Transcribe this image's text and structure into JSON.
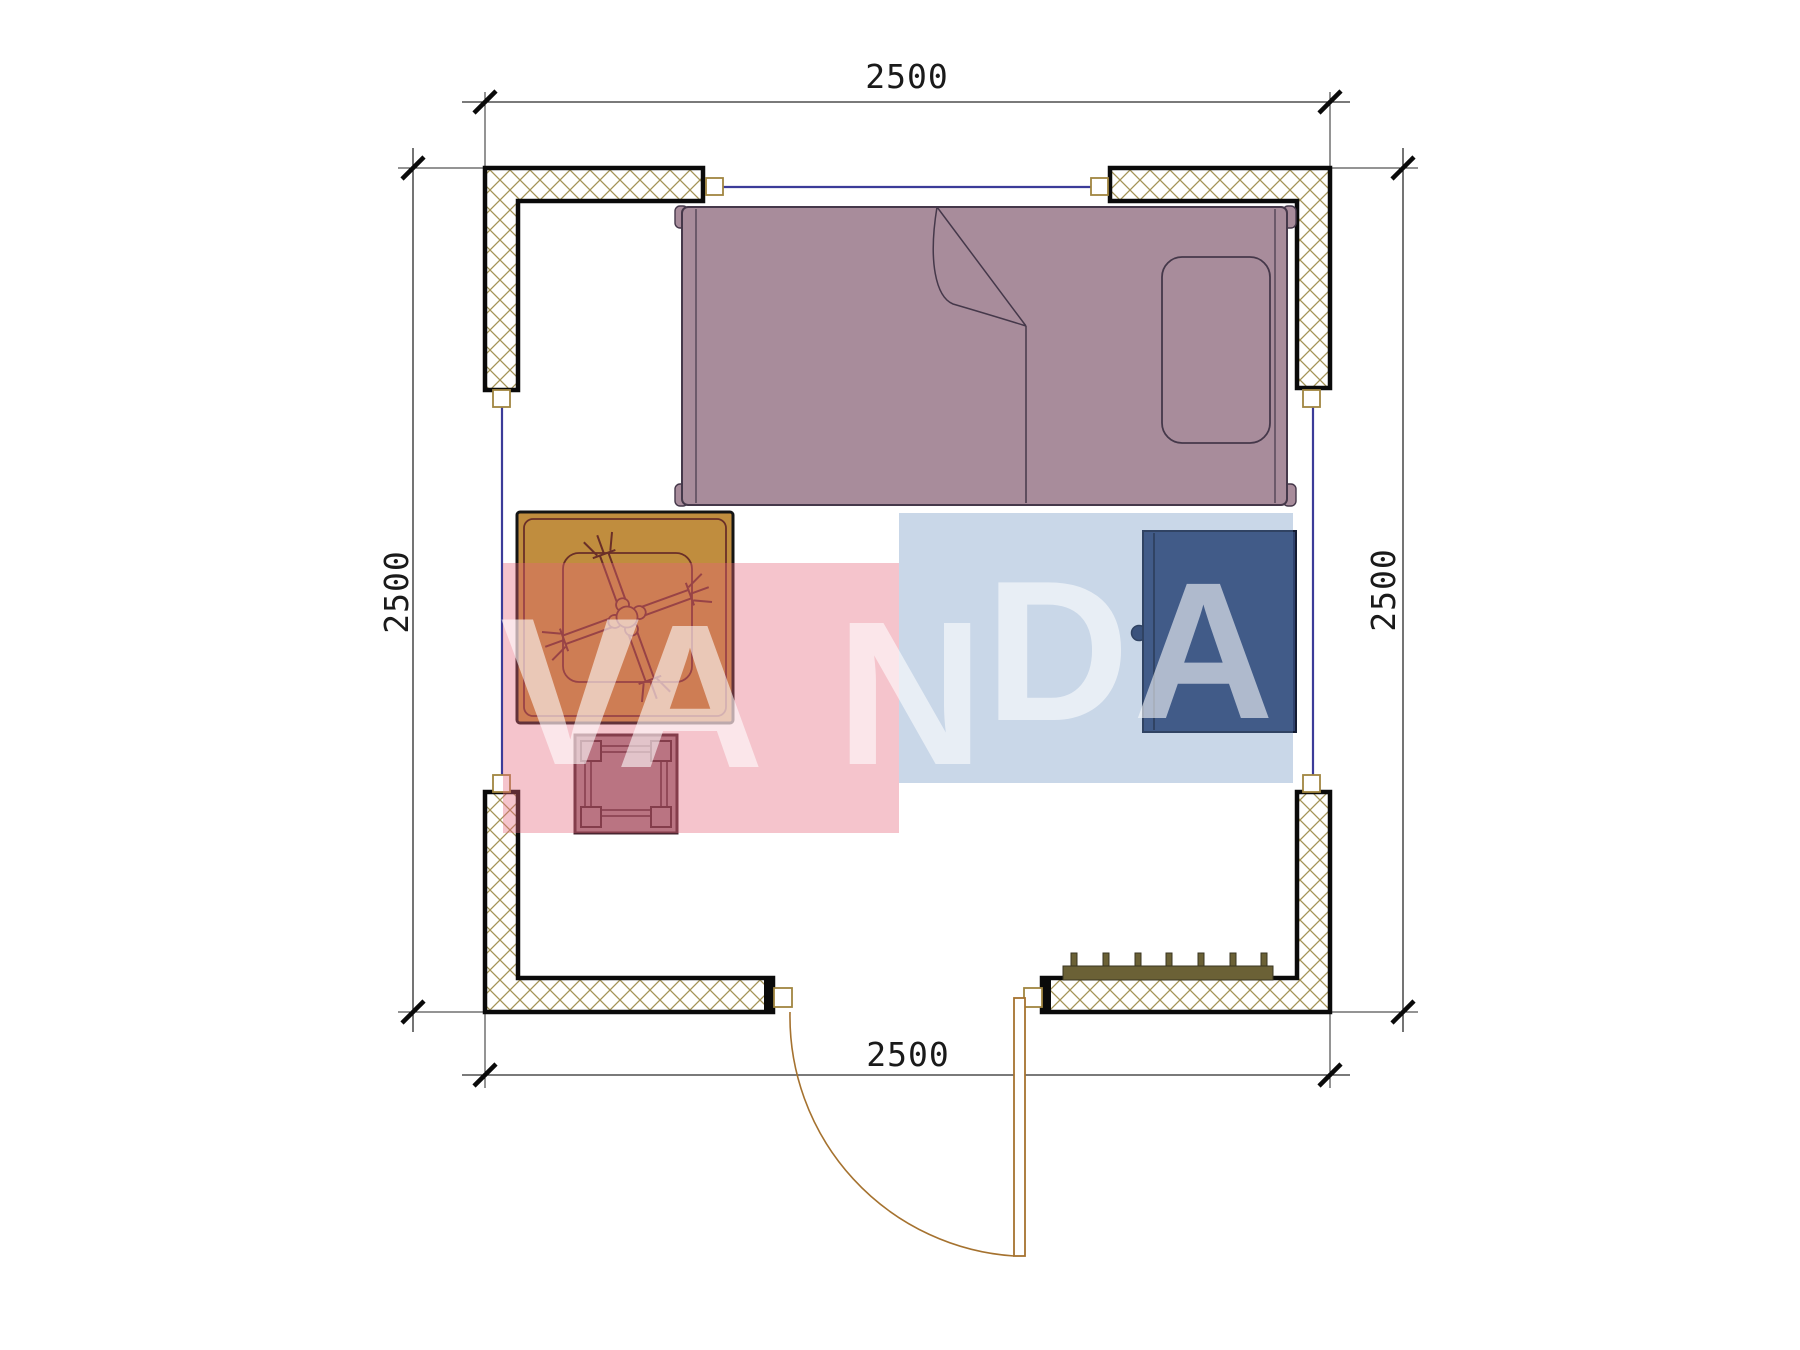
{
  "dimensions": {
    "top_label": "2500",
    "bottom_label": "2500",
    "left_label": "2500",
    "right_label": "2500",
    "color": "#1a1a1a"
  },
  "watermark": {
    "letters": [
      "V",
      "A",
      "N",
      "D",
      "A"
    ],
    "pink_color": "rgba(230,100,120,0.38)",
    "blue_color": "rgba(100,140,190,0.35)",
    "letter_color": "rgba(255,255,255,0.58)"
  },
  "plan": {
    "wall_hatch_color": "#a39356",
    "wall_border_color": "#0a0a0a",
    "window_line_color": "#3c3c99",
    "frame_color": "#a08540",
    "door_color": "#a5722f",
    "bed_fill": "#a88c9b",
    "bed_outline": "#45384a",
    "table_fill": "#c08d3e",
    "table_line": "#6a2f28",
    "table_border": "#141414",
    "stool_fill": "#a17f88",
    "stool_line": "#4a2630",
    "cabinet_fill": "#2e416c",
    "cabinet_line": "#151d33",
    "radiator_color": "#6b6136",
    "dimension_line_color": "#2a2a2a"
  }
}
